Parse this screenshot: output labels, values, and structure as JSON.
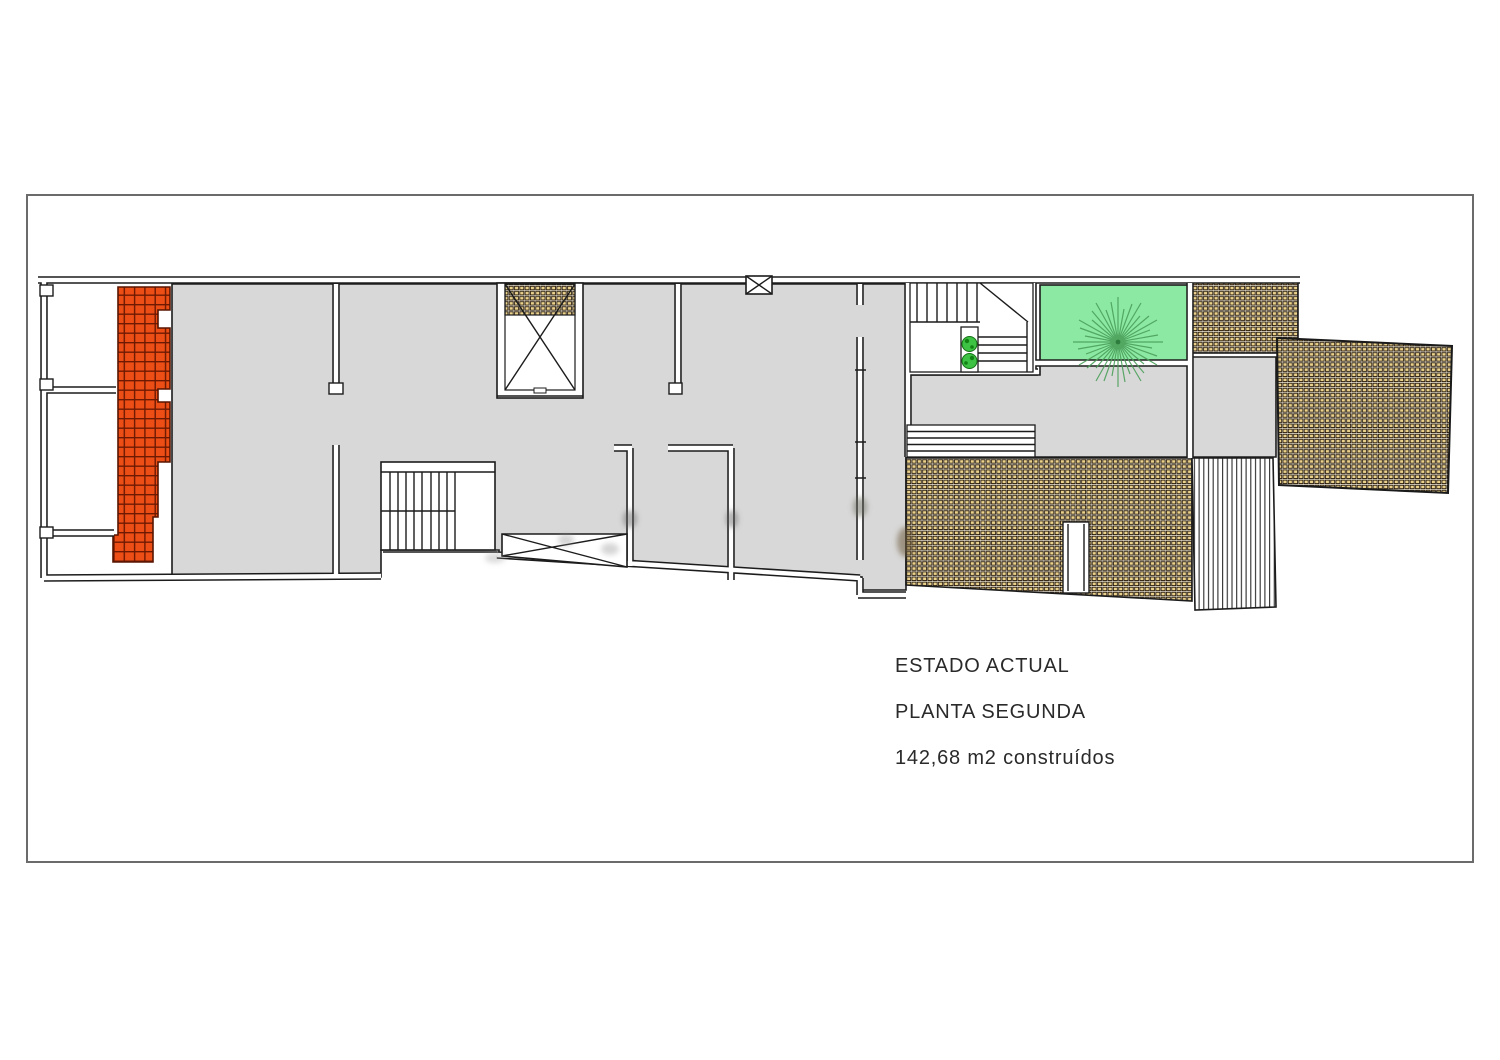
{
  "annotation": {
    "line1": "ESTADO ACTUAL",
    "line2": "PLANTA SEGUNDA",
    "line3": "142,68 m2 construídos"
  },
  "colors": {
    "background": "#FFFFFF",
    "frame_gray": "#6B6B6B",
    "wall_black": "#1C1C1C",
    "floor_gray": "#D8D8D8",
    "roof_orange": "#EC4E15",
    "orange_grid": "#6E1A02",
    "roof_tile_tan": "#EAD28D",
    "tile_outline": "#241708",
    "garden_green": "#8BE9A3",
    "tree_green": "#4BA05A",
    "plant_green": "#3DC244"
  }
}
